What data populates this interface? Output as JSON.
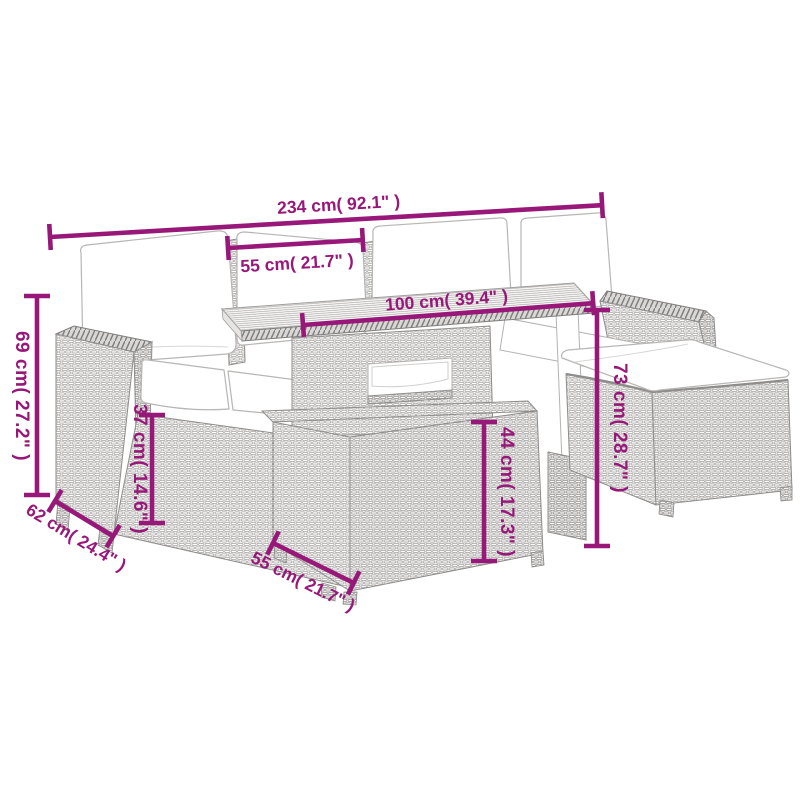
{
  "page": {
    "background": "#ffffff",
    "type": "product-dimension-diagram"
  },
  "illustration": {
    "subject": "6-piece poly rattan garden lounge set with cushions, slatted-top table, footstool cube and ottoman",
    "style": "gray line-art wicker weave",
    "line_color": "#9b9997",
    "cushion_color": "#ffffff"
  },
  "annotations": {
    "color": "#98187a",
    "dims": [
      {
        "id": "total-width",
        "label": "234 cm( 92.1\" )"
      },
      {
        "id": "seat-width",
        "label": "55 cm( 21.7\" )"
      },
      {
        "id": "table-length",
        "label": "100 cm( 39.4\" )"
      },
      {
        "id": "back-height",
        "label": "69 cm( 27.2\" )"
      },
      {
        "id": "seat-height",
        "label": "37 cm( 14.6\" )"
      },
      {
        "id": "seat-depth",
        "label": "62 cm( 24.4\" )"
      },
      {
        "id": "stool-width",
        "label": "55 cm( 21.7\" )"
      },
      {
        "id": "stool-height",
        "label": "44 cm( 17.3\" )"
      },
      {
        "id": "table-height",
        "label": "73 cm( 28.7\" )"
      }
    ]
  }
}
